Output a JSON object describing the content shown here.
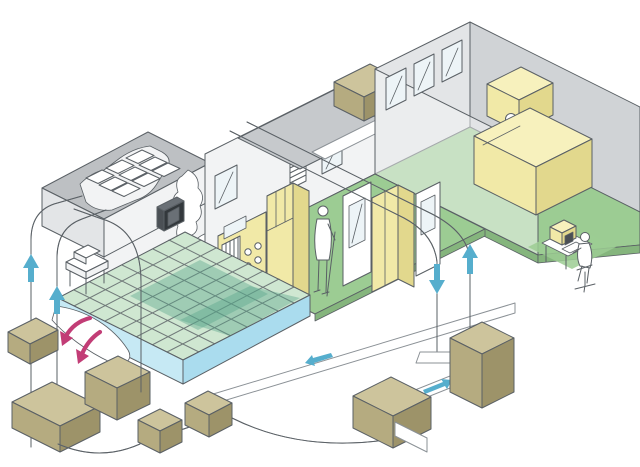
{
  "description": "Isometric cutaway illustration of a cleanroom facility: HVAC supply and return ducts with airflow arrows, ceiling HEPA filter plenum, raised perforated floor, fan and air-handling units, process equipment cabinets, and three workers (one standing in cleanroom, one at office desk, one at monitoring computer).",
  "colors": {
    "paper": "#ffffff",
    "outline": "#5a6065",
    "duct_edge": "#8b9196",
    "wall_light": "#e3e5e7",
    "wall_mid": "#d0d3d6",
    "ceiling_gray": "#bdc0c3",
    "band_gray": "#c6c9cc",
    "white_soft": "#f2f3f4",
    "floor_green": "#9ccc93",
    "floor_green_dark": "#85b57d",
    "grid_green": "#cfe7d1",
    "grid_line": "#3e7d5e",
    "grid_teal": "#57a689",
    "floor_blue": "#c6e9f4",
    "floor_blue_dark": "#aadcee",
    "yellow_top": "#f7f1bd",
    "yellow_front": "#f1e9a7",
    "yellow_side": "#e2d88d",
    "khaki_top": "#cdc49c",
    "khaki_front": "#b5ab80",
    "khaki_side": "#9d9369",
    "glass": "#edf4f7",
    "dark_box": "#4b5055",
    "dark_box_top": "#6a7076",
    "dark_box_side": "#33383c",
    "arrow_blue": "#56aecd",
    "arrow_pink": "#c23d76"
  },
  "inventory": {
    "rooms": 3,
    "people": 3,
    "windows": 6,
    "hepa_filter_tiles": 9,
    "fan_units_on_ceiling": 2,
    "air_handling_units": 7,
    "blue_airflow_arrows": [
      {
        "direction": "up"
      },
      {
        "direction": "up"
      },
      {
        "direction": "down"
      },
      {
        "direction": "up"
      },
      {
        "direction": "right"
      },
      {
        "direction": "left"
      }
    ],
    "pink_underfloor_arrows": [
      {
        "direction": "down-left"
      },
      {
        "direction": "down-left"
      }
    ]
  }
}
